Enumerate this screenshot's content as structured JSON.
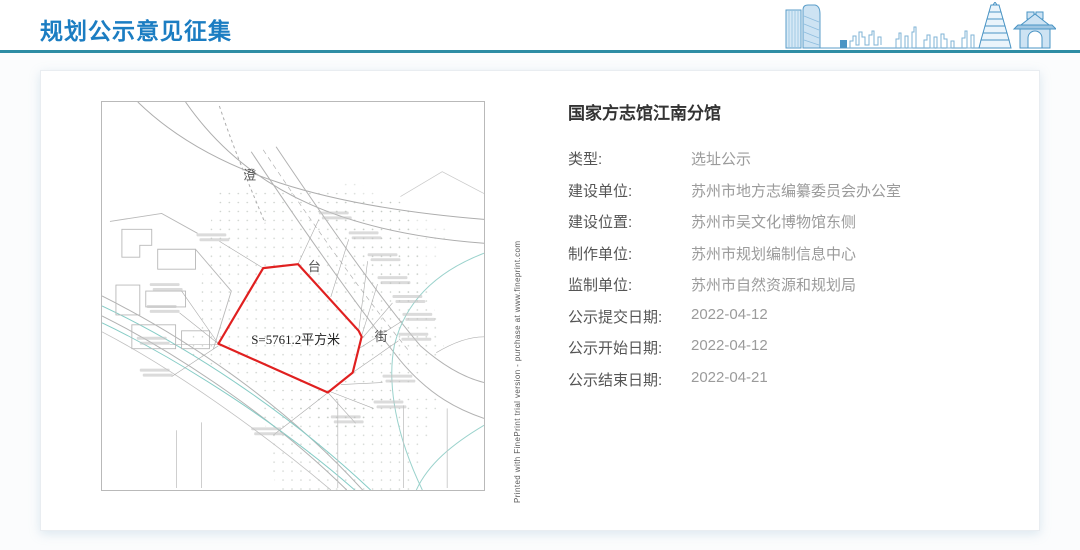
{
  "header": {
    "title": "规划公示意见征集",
    "accent_color": "#1b7dc2",
    "underline_color": "#2d8ca4"
  },
  "detail": {
    "title": "国家方志馆江南分馆",
    "rows": [
      {
        "label": "类型:",
        "value": "选址公示"
      },
      {
        "label": "建设单位:",
        "value": "苏州市地方志编纂委员会办公室"
      },
      {
        "label": "建设位置:",
        "value": "苏州市吴文化博物馆东侧"
      },
      {
        "label": "制作单位:",
        "value": "苏州市规划编制信息中心"
      },
      {
        "label": "监制单位:",
        "value": "苏州市自然资源和规划局"
      },
      {
        "label": "公示提交日期:",
        "value": "2022-04-12"
      },
      {
        "label": "公示开始日期:",
        "value": "2022-04-12"
      },
      {
        "label": "公示结束日期:",
        "value": "2022-04-21"
      }
    ]
  },
  "map": {
    "area_label": "S=5761.2平方米",
    "street_chars": [
      "澄",
      "台",
      "街"
    ],
    "boundary_color": "#e02020",
    "watermark": "Printed with FinePrint trial version - purchase at www.fineprint.com"
  }
}
